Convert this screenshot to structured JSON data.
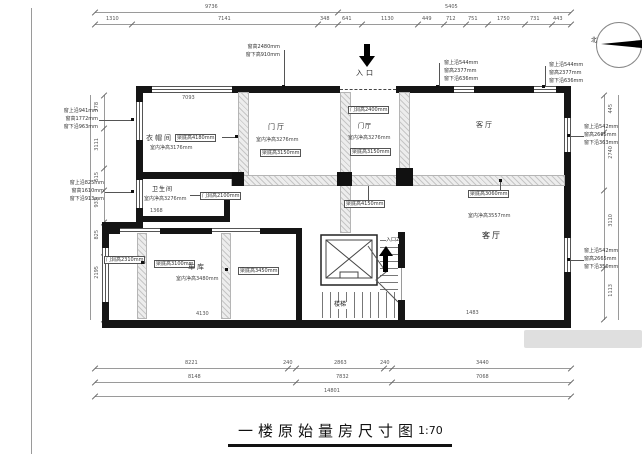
{
  "sheet": {
    "title": "一楼原始量房尺寸图",
    "scale": "1:70"
  },
  "compass": {
    "label": "北"
  },
  "entrance": {
    "top": "入口",
    "side": "入口2"
  },
  "rooms": {
    "cloakroom": {
      "name": "衣帽间",
      "beam": "梁底高4180mm",
      "height": "室内净高3176mm"
    },
    "foyer1": {
      "name": "门厅",
      "height": "室内净高3276mm",
      "beam": "梁底高3150mm"
    },
    "foyer2": {
      "name": "门厅",
      "height": "室内净高3276mm",
      "beam": "梁底高3150mm",
      "door": "门洞高2400mm"
    },
    "bathroom": {
      "name": "卫生间",
      "height": "室内净高3276mm",
      "door": "门洞高2100mm"
    },
    "living_top": {
      "name": "客厅"
    },
    "living_main": {
      "name": "客厅",
      "height": "室内净高3557mm",
      "beam": "梁底高3060mm"
    },
    "garage": {
      "name": "车库",
      "height": "室内净高3480mm",
      "door": "门洞高2310mm",
      "beam1": "梁底高3100mm",
      "beam2": "梁底高3450mm"
    },
    "stairs": {
      "name": "楼梯"
    },
    "corridor_beam": "梁底高4150mm"
  },
  "windows": {
    "left_upper": [
      "窗上沿941mm",
      "窗高1772mm",
      "窗下沿963mm"
    ],
    "left_lower": [
      "窗上沿825mm",
      "窗高1610mm",
      "窗下沿913mm"
    ],
    "top_center": [
      "窗高2480mm",
      "窗下高910mm"
    ],
    "top_mid": [
      "窗上沿544mm",
      "窗高2377mm",
      "窗下沿636mm"
    ],
    "top_right": [
      "窗上沿544mm",
      "窗高2377mm",
      "窗下沿636mm"
    ],
    "right_upper": [
      "窗上沿542mm",
      "窗高2665mm",
      "窗下沿363mm"
    ],
    "right_lower": [
      "窗上沿542mm",
      "窗高2665mm",
      "窗下沿350mm"
    ]
  },
  "dims": {
    "top1": [
      "9736",
      "5405"
    ],
    "top2": [
      "1310",
      "7141",
      "348",
      "641",
      "1130",
      "449",
      "712",
      "751",
      "1750",
      "731",
      "443"
    ],
    "bottom1": [
      "8221",
      "240",
      "2863",
      "240",
      "3440"
    ],
    "bottom2": [
      "8148",
      "7832",
      "7068"
    ],
    "bottom3": [
      "14801"
    ],
    "left": [
      "778",
      "3111",
      "515",
      "933",
      "825",
      "2195"
    ],
    "right": [
      "445",
      "2740",
      "3110",
      "1113"
    ],
    "inner": [
      "7093",
      "1368",
      "4130",
      "1483"
    ]
  }
}
